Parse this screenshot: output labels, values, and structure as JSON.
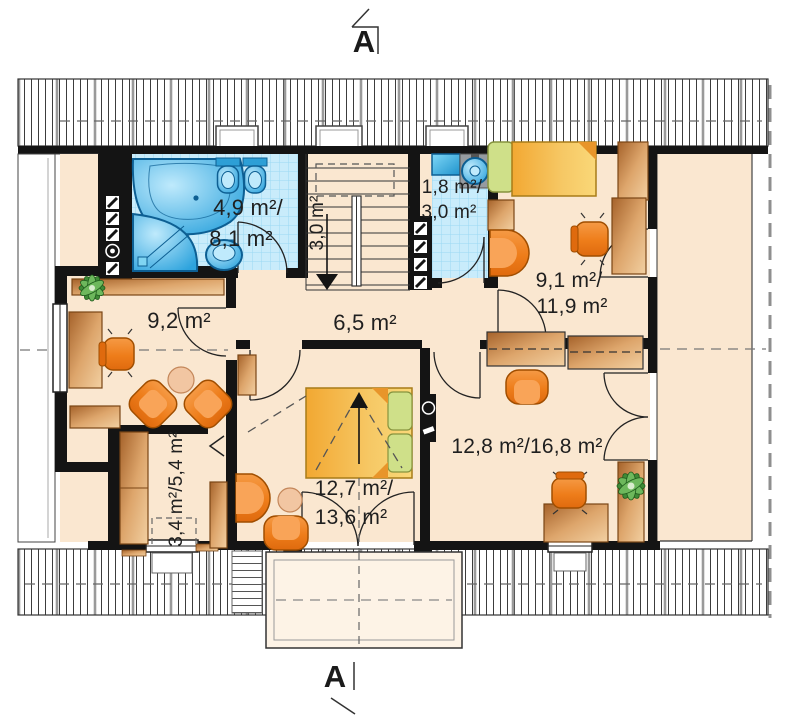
{
  "type": "architectural-floor-plan",
  "section_markers": {
    "top": "A",
    "bottom": "A"
  },
  "rooms": {
    "bathroom": {
      "name": "bathroom",
      "line1": "4,9 m²/",
      "line2": "8,1 m²"
    },
    "staircase": {
      "name": "staircase",
      "label": "3,0 m²"
    },
    "wc": {
      "name": "wc",
      "line1": "1,8 m²/",
      "line2": "3,0 m²"
    },
    "room_top_right": {
      "name": "room-top-right",
      "line1": "9,1 m²/",
      "line2": "11,9 m²"
    },
    "room_left": {
      "name": "room-left",
      "label": "9,2 m²"
    },
    "hall": {
      "name": "hall",
      "label": "6,5 m²"
    },
    "bedroom_center": {
      "name": "bedroom-center",
      "line1": "12,7 m²/",
      "line2": "13,6 m²"
    },
    "room_bottom_right": {
      "name": "room-bottom-right",
      "label": "12,8 m²/16,8 m²"
    },
    "wardrobe_closet": {
      "name": "wardrobe-closet",
      "label": "3,4 m²/5,4 m²"
    }
  },
  "symbols": [
    "bathtub",
    "shower",
    "toilet",
    "washbasin",
    "extractor-fan",
    "chimney-flue",
    "staircase-down-arrow",
    "roof-window",
    "balcony",
    "double-bed",
    "single-bed",
    "wardrobe",
    "desk",
    "office-chair",
    "armchair",
    "coffee-table",
    "plant",
    "tv-panel"
  ],
  "colors": {
    "floor": "#fae7d0",
    "tile": "#c9ecfb",
    "tile_grid": "#9bd9f3",
    "fixture_blue": "#3aaede",
    "wall": "#141414",
    "wood_dark": "#a5622a",
    "wood_light": "#f2d0a2",
    "upholstery_orange": "#ee7d1a",
    "bed_yellow": "#f6c865",
    "pillow_green": "#cfe089",
    "table_peach": "#f2c6a2",
    "plant_green": "#3f8a36",
    "roof_hatch": "#3c3c3c",
    "dashed_line": "#666666"
  }
}
